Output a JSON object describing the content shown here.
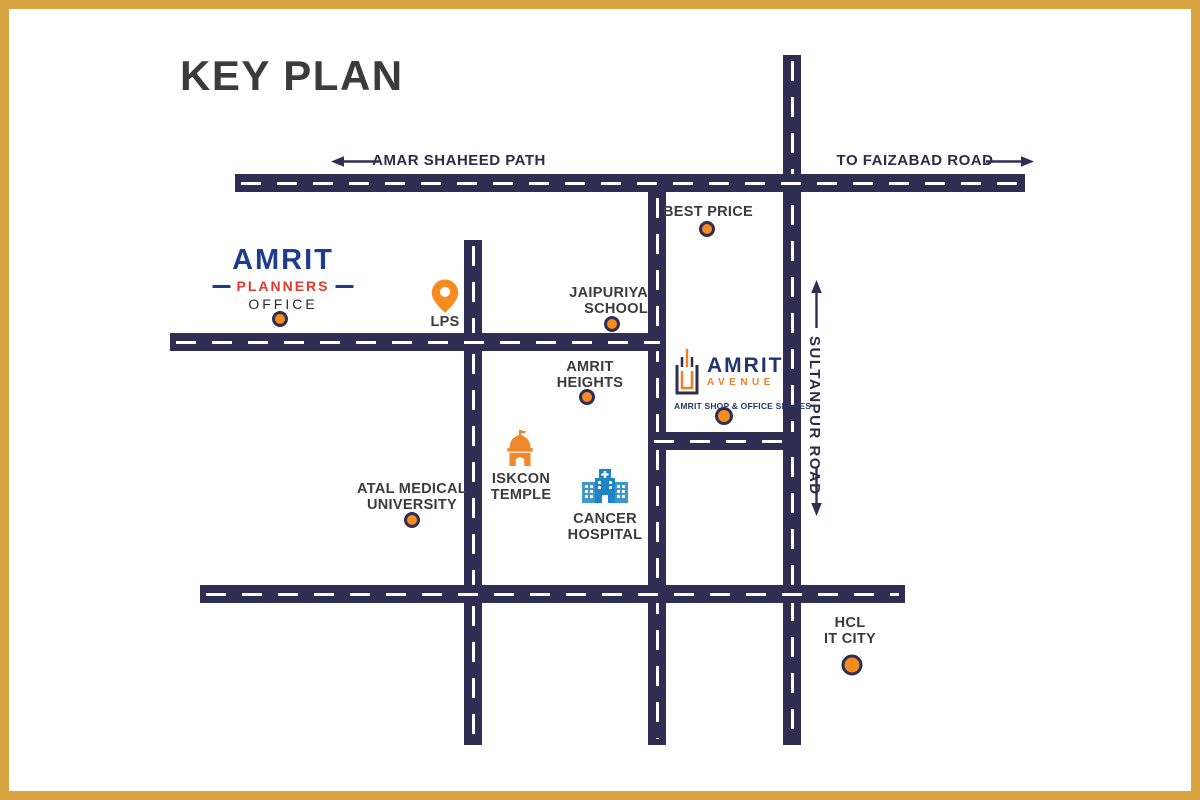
{
  "title": "KEY PLAN",
  "colors": {
    "road_navy": "#2F2D52",
    "accent_orange": "#F68B1F",
    "logo_blue": "#1F3D8F",
    "logo_red": "#E2382D",
    "avenue_orange": "#F08126",
    "hospital_blue": "#1D85C5",
    "frame_gold": "#D9A442",
    "background": "#FFFFFF"
  },
  "roads": {
    "amar_shaheed_path": "AMAR SHAHEED PATH",
    "to_faizabad_road": "TO FAIZABAD ROAD",
    "sultanpur_road": "SULTANPUR ROAD"
  },
  "logos": {
    "planners": {
      "name": "AMRIT",
      "sub": "PLANNERS",
      "caption": "OFFICE"
    },
    "avenue": {
      "name": "AMRIT",
      "sub": "AVENUE",
      "caption": "AMRIT SHOP & OFFICE SPACES"
    }
  },
  "pois": {
    "lps": "LPS",
    "best_price": "BEST PRICE",
    "jaipuriya": {
      "line1": "JAIPURIYA",
      "line2": "SCHOOL"
    },
    "amrit_heights": {
      "line1": "AMRIT",
      "line2": "HEIGHTS"
    },
    "iskcon": {
      "line1": "ISKCON",
      "line2": "TEMPLE"
    },
    "cancer": {
      "line1": "CANCER",
      "line2": "HOSPITAL"
    },
    "atal": {
      "line1": "ATAL MEDICAL",
      "line2": "UNIVERSITY"
    },
    "hcl": {
      "line1": "HCL",
      "line2": "IT CITY"
    }
  }
}
